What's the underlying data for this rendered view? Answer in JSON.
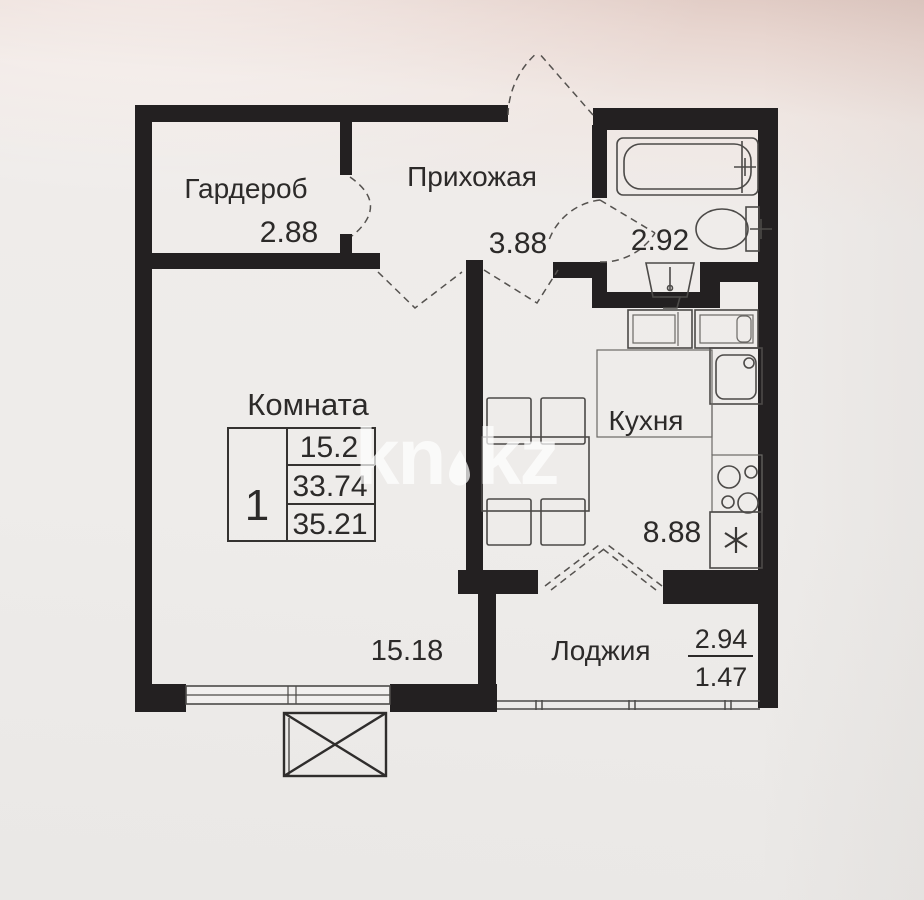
{
  "watermark": {
    "text": "kn.kz",
    "part1": "kn",
    "part2": "kz"
  },
  "rooms": {
    "wardrobe": {
      "name": "Гардероб",
      "area": "2.88"
    },
    "hallway": {
      "name": "Прихожая",
      "area": "3.88"
    },
    "bathroom": {
      "area": "2.92"
    },
    "living_room": {
      "name": "Комната",
      "area": "15.18"
    },
    "kitchen": {
      "name": "Кухня",
      "area": "8.88"
    },
    "loggia": {
      "name": "Лоджия",
      "area_total": "2.94",
      "area_reduced": "1.47"
    }
  },
  "summary_table": {
    "rooms_count": "1",
    "living_area": "15.2",
    "area_without_loggia": "33.74",
    "total_area": "35.21"
  }
}
